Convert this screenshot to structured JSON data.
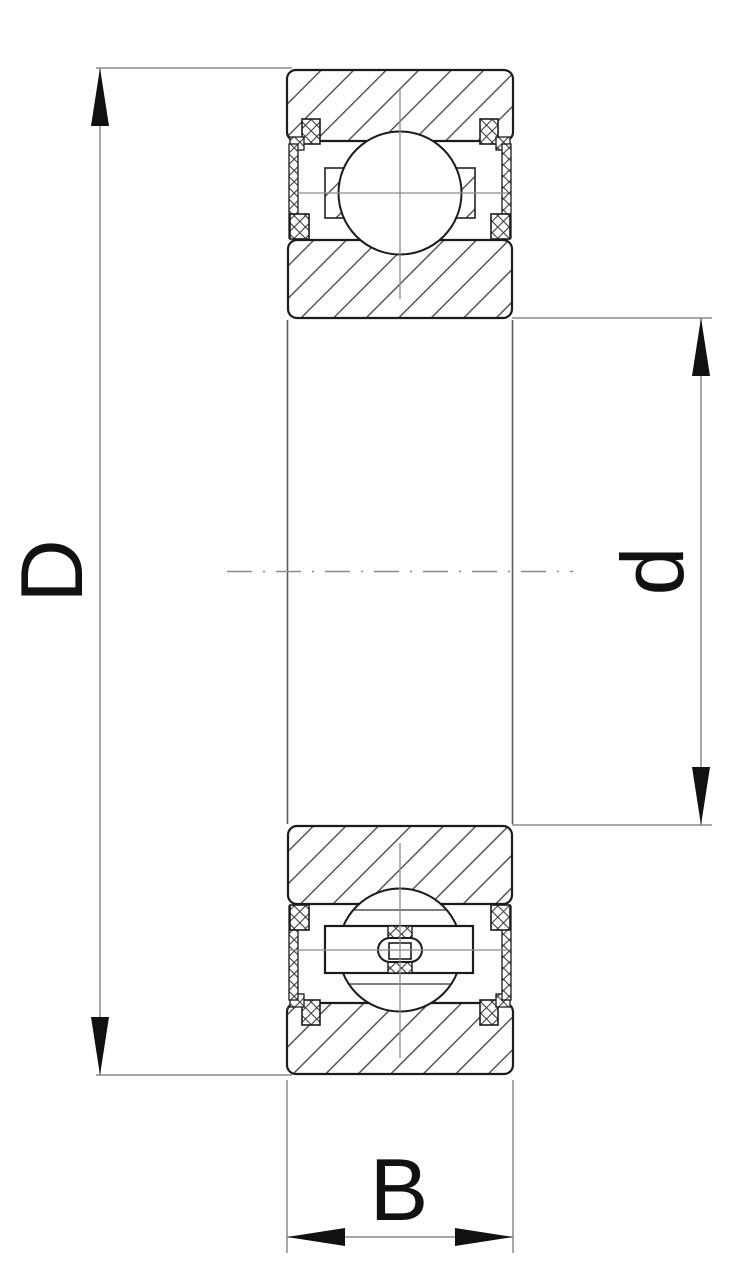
{
  "diagram": {
    "type": "ball-bearing-cross-section-dimension-drawing",
    "dimensions": [
      {
        "id": "outer-diameter",
        "label": "D"
      },
      {
        "id": "bore-diameter",
        "label": "d"
      },
      {
        "id": "width",
        "label": "B"
      }
    ],
    "colors": {
      "background": "#ffffff",
      "outline": "#1b1b1b",
      "hatch": "#4a4a4a",
      "dimension_lines": "#8c8c8c",
      "arrows": "#111111"
    }
  }
}
